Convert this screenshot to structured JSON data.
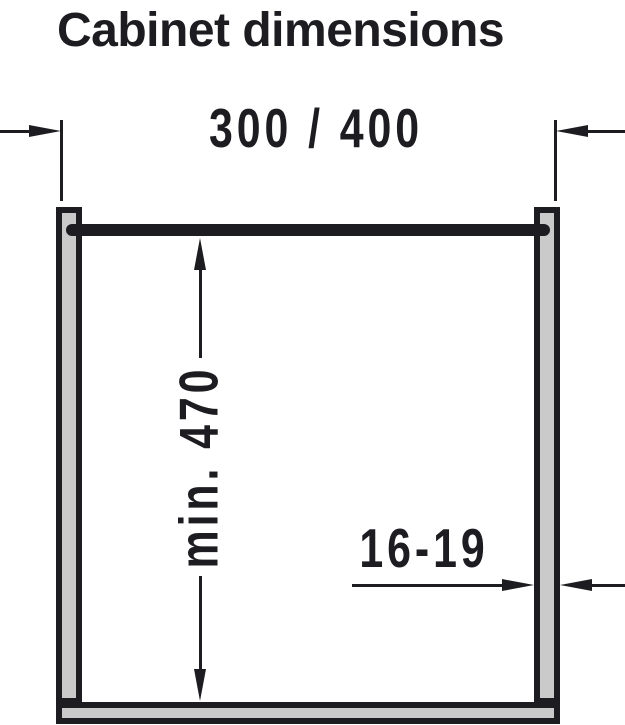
{
  "title": "Cabinet dimensions",
  "dimensions": {
    "cabinet_width": {
      "label": "300 / 400"
    },
    "interior_height": {
      "label": "min. 470"
    },
    "panel_thickness": {
      "label": "16-19"
    }
  },
  "colors": {
    "ink": "#1d1c21",
    "panel_fill": "#cacaca",
    "background": "#ffffff"
  }
}
